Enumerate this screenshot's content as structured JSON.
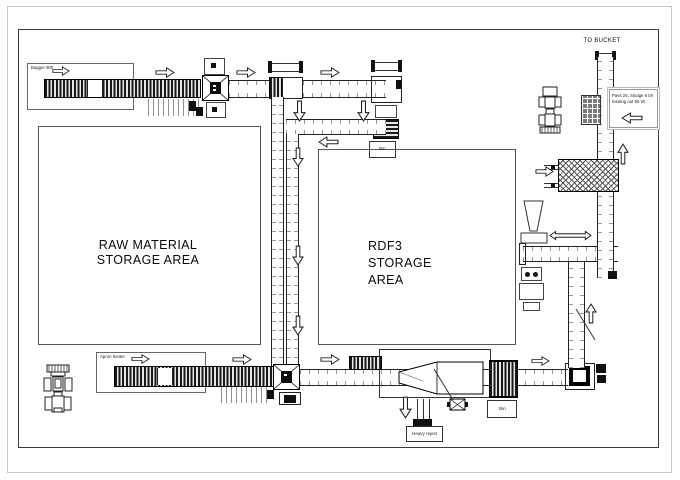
{
  "diagram": {
    "to_bucket": "TO BUCKET",
    "raw_storage": {
      "line1": "RAW MATERIAL",
      "line2": "STORAGE AREA"
    },
    "rdf3_storage": {
      "line1": "RDF3",
      "line2": "STORAGE",
      "line3": "AREA"
    },
    "infeed_top_label": "Bagger 800",
    "infeed_bottom_label": "Apron feeder",
    "bins": {
      "top": "Bin",
      "bottom": "Bin"
    },
    "heavy_reject": "Heavy reject",
    "info_box": {
      "line1": "Pass 25, Sludge 8 t/h",
      "line2": "feeding out 50 t/h"
    }
  },
  "colors": {
    "sheet_border": "#c8c8c8",
    "plant_boundary": "#3a3a3a",
    "line": "#333333",
    "belt_dark": "#191919",
    "grid_block": "#7a7a7a",
    "info_border": "#999999",
    "arrow_fill": "#ffffff",
    "arrow_stroke": "#222222"
  }
}
